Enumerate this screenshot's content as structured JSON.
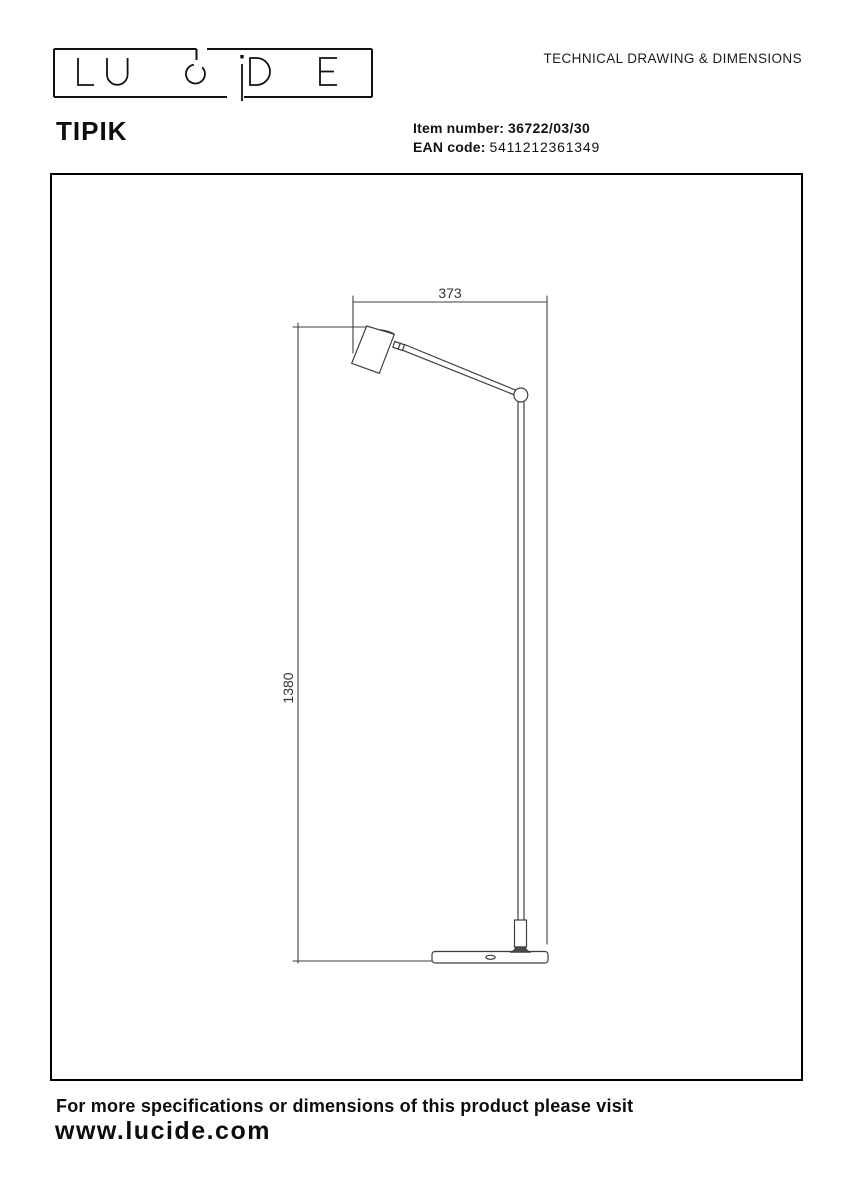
{
  "brand": {
    "logo_text": "LUCiDE"
  },
  "header": {
    "doc_title": "TECHNICAL DRAWING & DIMENSIONS",
    "product_name": "TIPIK",
    "item_number_label": "Item number:",
    "item_number_value": "36722/03/30",
    "ean_label": "EAN code:",
    "ean_value": "5411212361349"
  },
  "drawing": {
    "type": "technical-drawing",
    "dim_width": "373",
    "dim_height": "1380",
    "line_color": "#3f3f3f"
  },
  "footer": {
    "note": "For more specifications or dimensions of this product please visit",
    "website": "www.lucide.com"
  }
}
